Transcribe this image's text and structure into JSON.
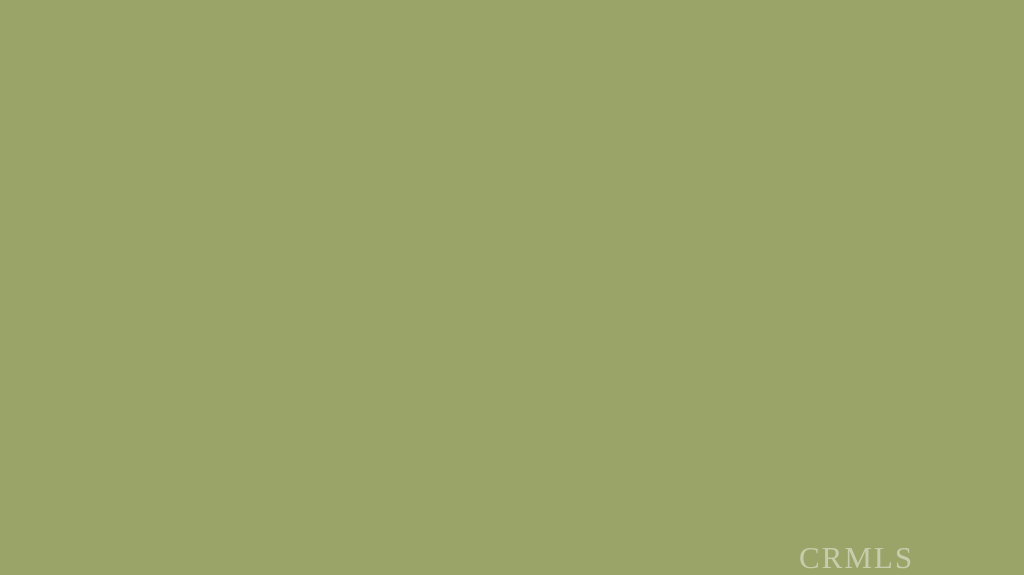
{
  "photo": {
    "description": "Aerial drone photo of a vacant high-desert land parcel outlined in red, dirt roads, scattered scrub, distant town and mountains",
    "watermark_text": "CRMLS"
  },
  "scene": {
    "size": {
      "w": 1024,
      "h": 575
    },
    "sky": {
      "top": "#4a9ade",
      "mid": "#93c5ee",
      "horizon": "#dbeefa",
      "bottom_y": 122
    },
    "clouds": [
      [
        165,
        64,
        27,
        9
      ],
      [
        140,
        71,
        16,
        6
      ],
      [
        223,
        58,
        24,
        10
      ],
      [
        410,
        28,
        36,
        13
      ],
      [
        452,
        41,
        24,
        9
      ],
      [
        577,
        60,
        33,
        11
      ],
      [
        713,
        67,
        44,
        13
      ],
      [
        668,
        75,
        24,
        8
      ],
      [
        871,
        13,
        12,
        4
      ]
    ],
    "ridge": {
      "c": "#6d91bf",
      "d": "M130,97 L180,90 L240,86 L300,84 L360,83 L430,86 L470,88 L505,84 L540,77 L565,74 L590,79 L620,86 L680,90 L740,92 L790,90 L830,87 L870,85 L915,83 L960,85 L1024,88 L1024,112 L130,112 Z"
    },
    "ridge2": {
      "c": "#8aabd0",
      "d": "M700,94 L780,90 L880,87 L1024,90 L1024,112 L700,112 Z",
      "o": 0.8
    },
    "mountain": {
      "top": "#5a6d83",
      "bottom": "#7e8b94",
      "shadow": "#4e6076",
      "d": "M0,22 L30,38 L60,52 L95,65 L125,74 L160,82 L220,89 L300,94 L380,97 L462,99 L462,126 L0,126 Z",
      "shadow_d": "M0,70 L120,86 L240,94 L350,98 L462,101 L462,126 L0,126 Z"
    },
    "town": {
      "y": 95,
      "h": 28,
      "base": "#c9d6e0",
      "speck_light": "#f3f6f8",
      "speck_dark": "#93a2ae",
      "speck_green": "#5f7252",
      "count": 430
    },
    "ground": {
      "stops": [
        [
          0,
          "#cdbf98"
        ],
        [
          0.16,
          "#beb288"
        ],
        [
          0.42,
          "#aaa576"
        ],
        [
          0.72,
          "#9ba26a"
        ],
        [
          1,
          "#909c62"
        ]
      ]
    },
    "tints": [
      [
        150,
        240,
        170,
        16,
        "#c9ba92",
        0.5
      ],
      [
        390,
        202,
        130,
        13,
        "#c6b78e",
        0.4
      ],
      [
        860,
        168,
        200,
        20,
        "#c3b48c",
        0.35
      ],
      [
        520,
        150,
        330,
        18,
        "#cbbd96",
        0.45
      ]
    ],
    "region_tints": [
      {
        "points": "560,575 993,252 1024,262 1024,575",
        "c": "#c7a98a",
        "o": 0.16
      },
      {
        "points": "0,310 168,354 500,545 430,575 0,575",
        "c": "#7e9152",
        "o": 0.1
      }
    ],
    "parcel_fill": {
      "c": "#b6bf6e",
      "o": 0.08
    },
    "roads": [
      {
        "d": "M-8,292 L168,354",
        "w": 10,
        "c": "#dccfae",
        "o": 0.95
      },
      {
        "d": "M168,354 L330,437",
        "w": 14,
        "c": "#dccfae",
        "o": 0.95
      },
      {
        "d": "M330,437 L520,532",
        "w": 19,
        "c": "#dfd2b0",
        "o": 0.95
      },
      {
        "d": "M520,532 L472,575",
        "w": 20,
        "c": "#dccfae",
        "o": 0.9
      },
      {
        "d": "M520,532 L600,575",
        "w": 24,
        "c": "#dccfae",
        "o": 0.9
      },
      {
        "d": "M560,548 L665,575",
        "w": 14,
        "c": "#d8cba9",
        "o": 0.85
      },
      {
        "d": "M545,520 L993,250",
        "w": 9,
        "c": "#d9cca9",
        "o": 0.9
      },
      {
        "d": "M990,245 L1024,260",
        "w": 8,
        "c": "#d9cca9",
        "o": 0.85
      },
      {
        "d": "M318,220 L678,213",
        "w": 5.5,
        "c": "#d7caa7",
        "o": 0.85
      },
      {
        "d": "M678,213 L990,243",
        "w": 6,
        "c": "#d7caa7",
        "o": 0.85
      },
      {
        "d": "M990,243 L1024,241",
        "w": 5,
        "c": "#d7caa7",
        "o": 0.8
      },
      {
        "d": "M60,233 C160,227 250,221 318,220",
        "w": 5,
        "c": "#d5c8a6",
        "o": 0.8
      },
      {
        "d": "M662,212 C655,190 650,165 646,142",
        "w": 3.5,
        "c": "#d5c8a6",
        "o": 0.6
      },
      {
        "d": "M756,227 C800,234 862,230 902,218",
        "w": 5,
        "c": "#d6c9a7",
        "o": 0.8
      },
      {
        "d": "M824,135 L1014,139",
        "w": 3,
        "c": "#cfc2a0",
        "o": 0.5
      },
      {
        "d": "M10,140 L210,133",
        "w": 3,
        "c": "#cfc2a0",
        "o": 0.5
      },
      {
        "d": "M420,130 L600,126",
        "w": 2.5,
        "c": "#cfc2a0",
        "o": 0.45
      }
    ],
    "junction": [
      [
        566,
        506,
        78,
        38,
        -28,
        "#d5c3a1",
        0.85
      ],
      [
        598,
        552,
        95,
        26,
        -12,
        "#d8c6a3",
        0.9
      ],
      [
        500,
        560,
        55,
        20,
        -35,
        "#d3c1a0",
        0.8
      ]
    ],
    "tracks": [
      {
        "d": "M-8,294 L168,356 L520,533",
        "c": "#bfae8a",
        "o": 0.55,
        "w": 1.6
      },
      {
        "d": "M300,420 C360,455 440,500 505,535",
        "c": "#b49e7c",
        "o": 0.45,
        "w": 1.6
      },
      {
        "d": "M540,398 C548,360 556,326 566,300",
        "c": "#bfb08a",
        "o": 0.5,
        "w": 2
      },
      {
        "d": "M620,470 C660,440 700,430 740,438",
        "c": "#a89a74",
        "o": 0.3,
        "w": 1.5
      },
      {
        "d": "M600,500 C650,470 690,468 730,480",
        "c": "#a89a74",
        "o": 0.25,
        "w": 1.5
      }
    ],
    "avoid": [
      [
        -8,
        292,
        168,
        354,
        11
      ],
      [
        168,
        354,
        520,
        532,
        16
      ],
      [
        520,
        532,
        648,
        575,
        24
      ],
      [
        520,
        532,
        472,
        575,
        18
      ],
      [
        545,
        520,
        993,
        250,
        9
      ],
      [
        318,
        220,
        678,
        213,
        6
      ],
      [
        678,
        213,
        990,
        243,
        6
      ],
      [
        618,
        452,
        618,
        452,
        28
      ],
      [
        566,
        506,
        566,
        506,
        52
      ],
      [
        598,
        552,
        598,
        552,
        62
      ],
      [
        566,
        293,
        566,
        293,
        20
      ]
    ],
    "buildings": [
      [
        2,
        152,
        20,
        8,
        "#e6e4dc",
        "#c9c6be"
      ],
      [
        28,
        150,
        16,
        8,
        "#e2e0d8",
        "#c5c2ba"
      ],
      [
        58,
        154,
        14,
        7,
        "#dcd8ce",
        "#bab6ac"
      ],
      [
        197,
        147,
        34,
        19,
        "#e9e5dc",
        "#696e74"
      ],
      [
        315,
        160,
        38,
        17,
        "#d6cec0",
        "#6e7278"
      ],
      [
        219,
        184,
        47,
        15,
        "#f0f0ea",
        "#c6c8c6"
      ],
      [
        132,
        172,
        35,
        11,
        "#7ea7c7",
        "#a8c4d8"
      ],
      [
        169,
        170,
        28,
        10,
        "#e4e6e6",
        "#eeeeec"
      ],
      [
        232,
        168,
        12,
        7,
        "#ecece8",
        "#d8d8d4"
      ],
      [
        247,
        167,
        10,
        6,
        "#e6e6e2",
        "#d2d2ce"
      ],
      [
        822,
        162,
        80,
        12,
        "#eae9e3",
        "#d6d4cc"
      ],
      [
        732,
        164,
        16,
        9,
        "#d9d5ca",
        "#b8b4a8"
      ],
      [
        760,
        168,
        18,
        11,
        "#8e7c62",
        "#6f6352"
      ],
      [
        802,
        190,
        40,
        17,
        "#d5d1c5",
        "#55595f"
      ],
      [
        843,
        198,
        20,
        11,
        "#97826a",
        "#7a6853"
      ],
      [
        864,
        196,
        34,
        9,
        "#ad9574",
        "#927c5c"
      ],
      [
        899,
        196,
        36,
        15,
        "#eae8e0",
        "#a4a6a8"
      ],
      [
        938,
        200,
        38,
        16,
        "#d3c1a2",
        "#878a8f"
      ],
      [
        998,
        243,
        20,
        15,
        "#8a6a4e",
        "#c5a67b"
      ]
    ],
    "doors": [
      [
        253,
        189,
        11,
        9,
        "#4b4b45"
      ]
    ],
    "trees": [
      [
        795,
        172,
        10,
        8
      ],
      [
        868,
        170,
        8,
        6
      ],
      [
        926,
        184,
        14,
        12
      ],
      [
        963,
        198,
        21,
        15
      ],
      [
        991,
        187,
        11,
        9
      ],
      [
        606,
        191,
        11,
        7
      ],
      [
        626,
        197,
        7,
        5
      ],
      [
        1014,
        306,
        16,
        24
      ]
    ],
    "tree_color": "#3c4930",
    "poles": [
      [
        578,
        186
      ],
      [
        746,
        183
      ],
      [
        690,
        197
      ]
    ],
    "fence": {
      "x1": 549,
      "y1": 546,
      "x2": 993,
      "y2": 253,
      "posts": 26,
      "c": "#f6f6f1"
    },
    "fence2": {
      "x1": 772,
      "y1": 572,
      "x2": 838,
      "y2": 545,
      "posts": 6,
      "c": "#f6f6f1"
    },
    "puddle": {
      "cx": 618,
      "cy": 452,
      "rx": 27,
      "ry": 9,
      "rot": -10,
      "c": "#8d6b49",
      "inner": "#a5805a"
    },
    "debris": {
      "cx": 566,
      "cy": 293,
      "rx": 23,
      "ry": 7,
      "c": "#b3b1a5",
      "dot": "#56524b"
    },
    "boundary": {
      "color": "#da2517",
      "width": 5.5,
      "points": "170,352 678,211 990,243 520,531"
    },
    "texture": {
      "seed": 20240613,
      "fg_count": 950,
      "fg_colors": [
        "#4d5937",
        "#414d2f",
        "#59653f",
        "#37432a"
      ],
      "mg_count": 330,
      "mg_colors": [
        "#6d774f",
        "#7b845a",
        "#5f6a45"
      ],
      "grass_count": 260,
      "grass_color": "#cfc094",
      "bld_specks": 26
    }
  }
}
